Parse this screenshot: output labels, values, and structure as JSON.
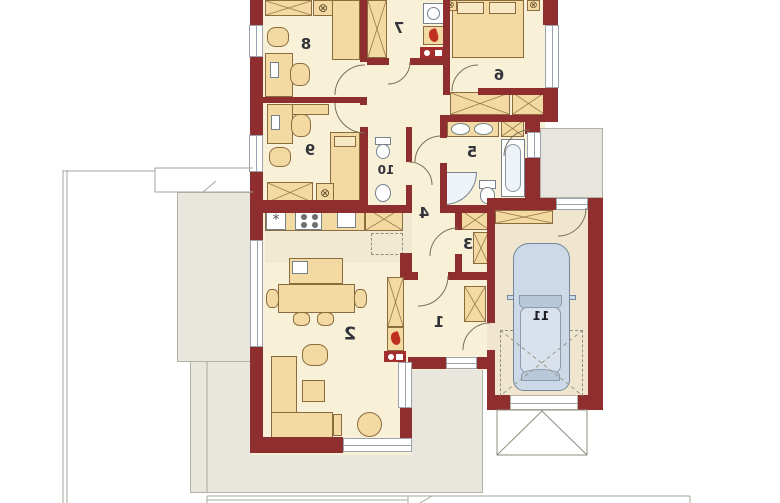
{
  "plan": {
    "type": "house-floor-plan",
    "mirrored": true,
    "colors": {
      "wall": "#8e2e2e",
      "floor": "#f8f1d8",
      "garage_floor": "#f0e6d0",
      "terrace": "#e9e6de",
      "furniture": "#f3d9a2",
      "car": "#ccd9e6",
      "flame": "#c03020",
      "label": "#33333b"
    },
    "rooms": [
      {
        "label": "1"
      },
      {
        "label": "2"
      },
      {
        "label": "3"
      },
      {
        "label": "4"
      },
      {
        "label": "5"
      },
      {
        "label": "6"
      },
      {
        "label": "7"
      },
      {
        "label": "8"
      },
      {
        "label": "9"
      },
      {
        "label": "10"
      },
      {
        "label": "11"
      }
    ],
    "icons": {
      "lamp": "⊗",
      "fridge": "*"
    }
  }
}
